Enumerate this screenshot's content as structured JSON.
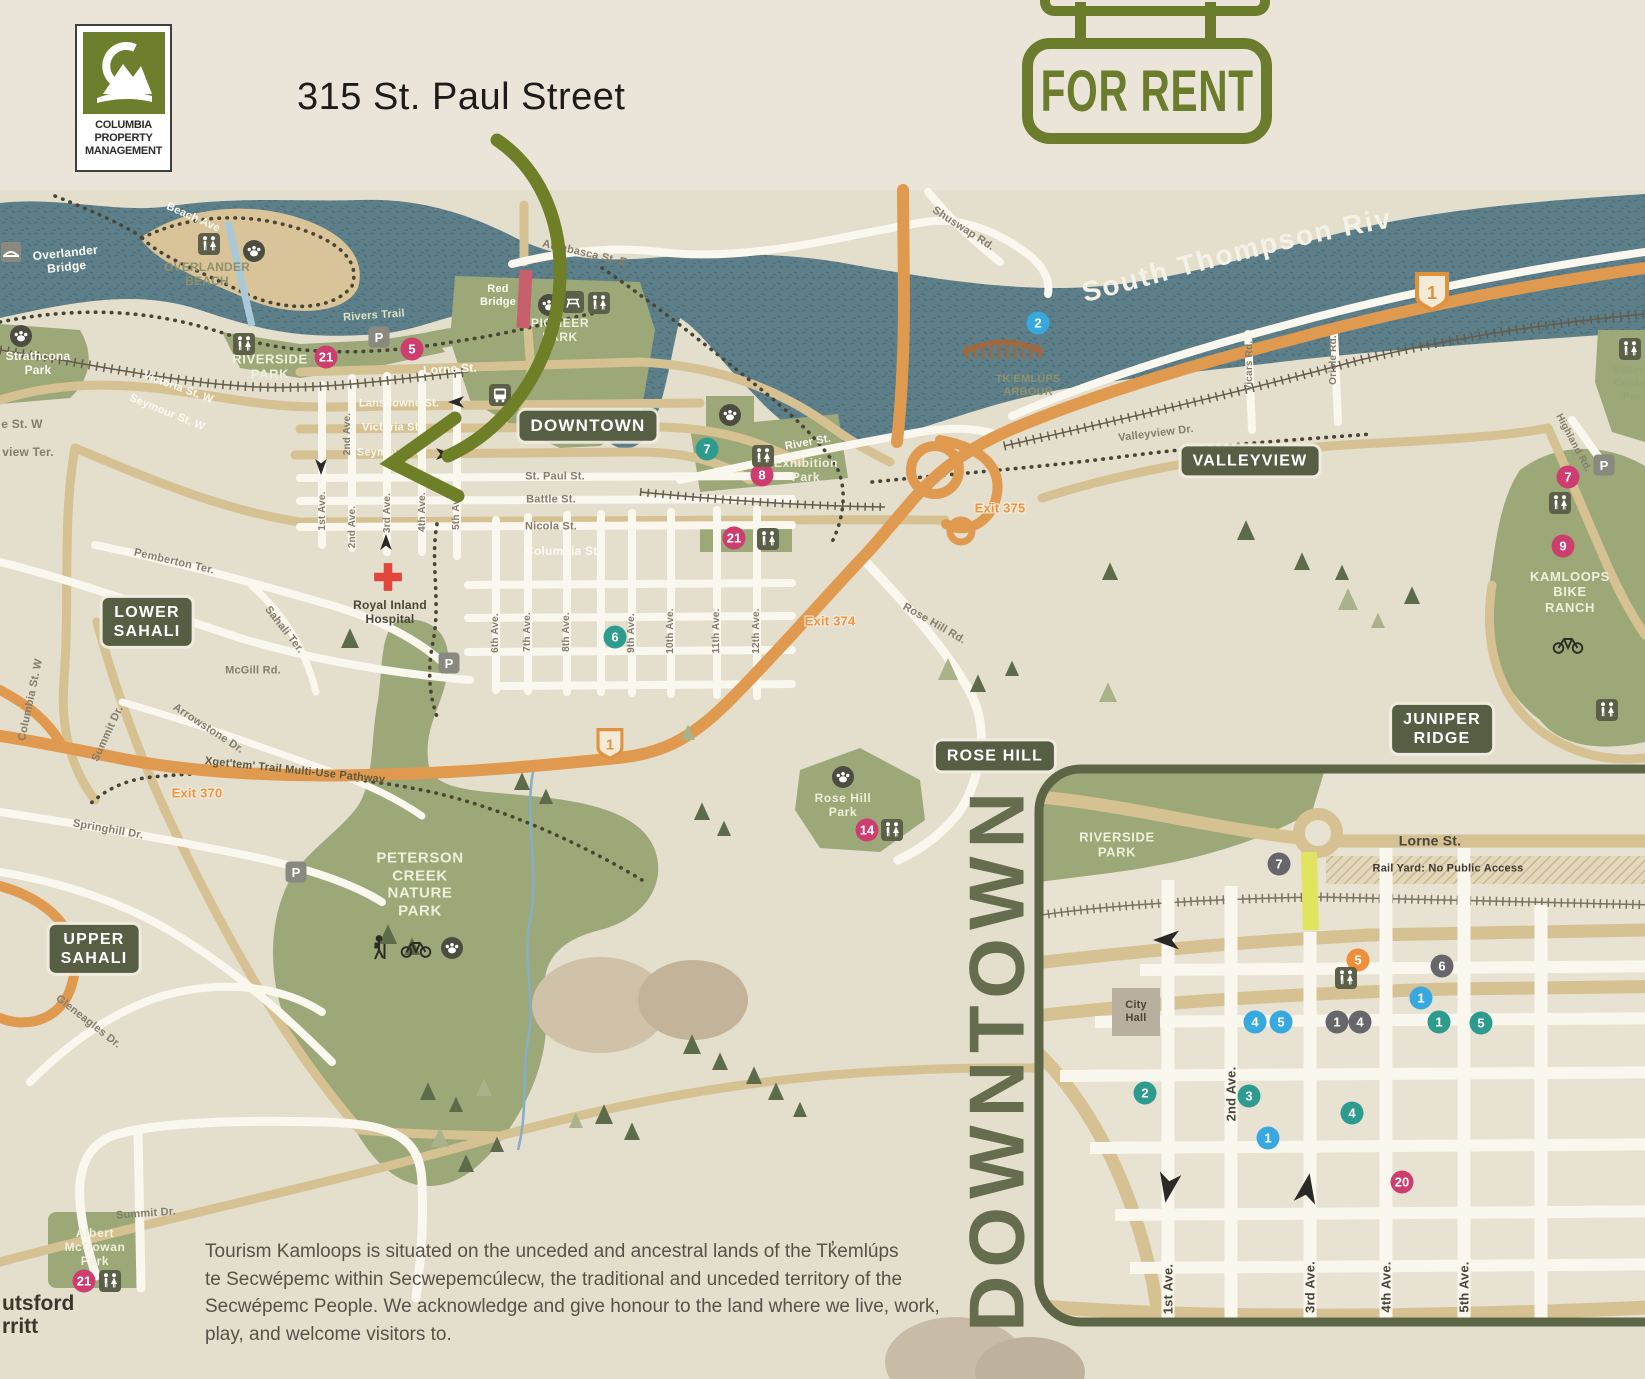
{
  "header": {
    "logo": {
      "monogram": "CM",
      "line1": "COLUMBIA",
      "line2": "PROPERTY",
      "line3": "MANAGEMENT"
    },
    "title": "315 St. Paul Street",
    "sign": "FOR RENT"
  },
  "colors": {
    "brand_green": "#6d7e2c",
    "badge_olive": "#565e44",
    "river_teal": "#5d7f8a",
    "highway_orange": "#e09a50",
    "pink": "#ce3d6f",
    "teal": "#2d9c8e",
    "blue": "#38a9e0",
    "orange": "#ef8f3a",
    "grey": "#67676b"
  },
  "map": {
    "river_label": "South Thompson River",
    "region_badges": [
      {
        "t": "DOWNTOWN",
        "x": 588,
        "y": 426,
        "s": 17
      },
      {
        "t": "VALLEYVIEW",
        "x": 1250,
        "y": 461,
        "s": 16
      },
      {
        "t": "LOWER\nSAHALI",
        "x": 147,
        "y": 622,
        "s": 16
      },
      {
        "t": "UPPER\nSAHALI",
        "x": 94,
        "y": 949,
        "s": 16
      },
      {
        "t": "ROSE HILL",
        "x": 995,
        "y": 756,
        "s": 16
      },
      {
        "t": "JUNIPER\nRIDGE",
        "x": 1442,
        "y": 729,
        "s": 16
      }
    ],
    "labels": [
      {
        "t": "Overlander\nBridge",
        "x": 66,
        "y": 260,
        "r": -6,
        "c": "white",
        "s": 12
      },
      {
        "t": "Beach Ave",
        "x": 193,
        "y": 218,
        "r": 24,
        "c": "white",
        "s": 11
      },
      {
        "t": "OVERLANDER\nBEACH",
        "x": 207,
        "y": 274,
        "c": "olive",
        "s": 12
      },
      {
        "t": "Strathcona\nPark",
        "x": 38,
        "y": 363,
        "c": "white",
        "s": 12
      },
      {
        "t": "RIVERSIDE\nPARK",
        "x": 270,
        "y": 367,
        "c": "parkname",
        "s": 13
      },
      {
        "t": "Rivers Trail",
        "x": 374,
        "y": 316,
        "r": -4,
        "c": "trail",
        "s": 11
      },
      {
        "t": "PIONEER\nPARK",
        "x": 560,
        "y": 330,
        "c": "parkname",
        "s": 12
      },
      {
        "t": "Red\nBridge",
        "x": 498,
        "y": 296,
        "c": "white",
        "s": 11
      },
      {
        "t": "Athabasca St. E.",
        "x": 586,
        "y": 254,
        "r": 13,
        "c": "grey",
        "s": 11
      },
      {
        "t": "Shuswap Rd.",
        "x": 963,
        "y": 229,
        "r": 33,
        "c": "grey",
        "s": 11
      },
      {
        "t": "Lorne St.",
        "x": 450,
        "y": 369,
        "r": -3,
        "c": "white",
        "s": 12
      },
      {
        "t": "Lansdowne St.",
        "x": 399,
        "y": 404,
        "c": "white",
        "s": 11
      },
      {
        "t": "Victoria St.",
        "x": 392,
        "y": 428,
        "c": "white",
        "s": 11
      },
      {
        "t": "Seymour St.",
        "x": 390,
        "y": 453,
        "c": "white",
        "s": 11
      },
      {
        "t": "Victoria St. W",
        "x": 178,
        "y": 388,
        "r": 20,
        "c": "white",
        "s": 11
      },
      {
        "t": "Seymour St. W",
        "x": 167,
        "y": 413,
        "r": 22,
        "c": "white",
        "s": 11
      },
      {
        "t": "St. Paul St.",
        "x": 555,
        "y": 477,
        "c": "grey",
        "s": 11
      },
      {
        "t": "Battle St.",
        "x": 551,
        "y": 500,
        "c": "grey",
        "s": 11
      },
      {
        "t": "Nicola St.",
        "x": 551,
        "y": 527,
        "c": "grey",
        "s": 11
      },
      {
        "t": "Columbia St.",
        "x": 563,
        "y": 551,
        "c": "white",
        "s": 12
      },
      {
        "t": "River St.",
        "x": 808,
        "y": 443,
        "r": -10,
        "c": "white",
        "s": 11
      },
      {
        "t": "e St. W",
        "x": 22,
        "y": 424,
        "c": "grey",
        "s": 12
      },
      {
        "t": "view Ter.",
        "x": 28,
        "y": 452,
        "c": "grey",
        "s": 12
      },
      {
        "t": "1st Ave.",
        "x": 323,
        "y": 511,
        "r": -90,
        "c": "grey",
        "s": 10
      },
      {
        "t": "2nd Ave.",
        "x": 348,
        "y": 434,
        "r": -90,
        "c": "grey",
        "s": 10
      },
      {
        "t": "2nd Ave.",
        "x": 353,
        "y": 527,
        "r": -90,
        "c": "grey",
        "s": 10
      },
      {
        "t": "3rd Ave.",
        "x": 388,
        "y": 513,
        "r": -90,
        "c": "grey",
        "s": 10
      },
      {
        "t": "4th Ave.",
        "x": 423,
        "y": 512,
        "r": -90,
        "c": "grey",
        "s": 10
      },
      {
        "t": "5th Ave.",
        "x": 457,
        "y": 510,
        "r": -90,
        "c": "grey",
        "s": 10
      },
      {
        "t": "6th Ave.",
        "x": 496,
        "y": 633,
        "r": -90,
        "c": "grey",
        "s": 10
      },
      {
        "t": "7th Ave.",
        "x": 528,
        "y": 632,
        "r": -90,
        "c": "grey",
        "s": 10
      },
      {
        "t": "8th Ave.",
        "x": 567,
        "y": 632,
        "r": -90,
        "c": "grey",
        "s": 10
      },
      {
        "t": "9th Ave.",
        "x": 632,
        "y": 633,
        "r": -90,
        "c": "grey",
        "s": 10
      },
      {
        "t": "10th Ave.",
        "x": 671,
        "y": 631,
        "r": -90,
        "c": "grey",
        "s": 10
      },
      {
        "t": "11th Ave.",
        "x": 717,
        "y": 631,
        "r": -90,
        "c": "grey",
        "s": 10
      },
      {
        "t": "12th Ave.",
        "x": 757,
        "y": 631,
        "r": -90,
        "c": "grey",
        "s": 10
      },
      {
        "t": "Vicars Rd.",
        "x": 1250,
        "y": 366,
        "r": -90,
        "c": "grey",
        "s": 10
      },
      {
        "t": "Oriole Rd.",
        "x": 1334,
        "y": 360,
        "r": -90,
        "c": "grey",
        "s": 10
      },
      {
        "t": "Valleyview Dr.",
        "x": 1156,
        "y": 434,
        "r": -7,
        "c": "grey",
        "s": 11
      },
      {
        "t": "Highland Rd.",
        "x": 1573,
        "y": 443,
        "r": 62,
        "c": "grey",
        "s": 10
      },
      {
        "t": "Rose Hill Rd.",
        "x": 934,
        "y": 624,
        "r": 30,
        "c": "grey",
        "s": 11
      },
      {
        "t": "Exhibition\nPark",
        "x": 806,
        "y": 470,
        "c": "parkname",
        "s": 12
      },
      {
        "t": "TK'EMLÚPS\nARBOUR",
        "x": 1028,
        "y": 386,
        "c": "olive",
        "s": 11
      },
      {
        "t": "Royal Inland\nHospital",
        "x": 390,
        "y": 612,
        "c": "poi",
        "s": 12
      },
      {
        "t": "Pemberton Ter.",
        "x": 174,
        "y": 562,
        "r": 13,
        "c": "grey",
        "s": 11
      },
      {
        "t": "Sahali Ter.",
        "x": 284,
        "y": 630,
        "r": 52,
        "c": "grey",
        "s": 11
      },
      {
        "t": "McGill Rd.",
        "x": 253,
        "y": 671,
        "c": "grey",
        "s": 11
      },
      {
        "t": "Arrowstone Dr.",
        "x": 208,
        "y": 729,
        "r": 33,
        "c": "grey",
        "s": 11
      },
      {
        "t": "Columbia St. W",
        "x": 31,
        "y": 700,
        "r": -78,
        "c": "grey",
        "s": 11
      },
      {
        "t": "Summit Dr.",
        "x": 108,
        "y": 734,
        "r": -65,
        "c": "grey",
        "s": 11
      },
      {
        "t": "Xget'tem' Trail Multi-Use Pathway",
        "x": 295,
        "y": 771,
        "r": 6,
        "c": "traildark",
        "s": 11
      },
      {
        "t": "Exit 375",
        "x": 1000,
        "y": 508,
        "c": "exit",
        "s": 13
      },
      {
        "t": "Exit 374",
        "x": 830,
        "y": 621,
        "c": "exit",
        "s": 13
      },
      {
        "t": "Exit 370",
        "x": 197,
        "y": 793,
        "c": "exit",
        "s": 13
      },
      {
        "t": "Springhill Dr.",
        "x": 108,
        "y": 830,
        "r": 10,
        "c": "grey",
        "s": 11
      },
      {
        "t": "Gleneagles Dr.",
        "x": 88,
        "y": 1022,
        "r": 38,
        "c": "grey",
        "s": 11
      },
      {
        "t": "PETERSON\nCREEK\nNATURE\nPARK",
        "x": 420,
        "y": 885,
        "c": "parkname",
        "s": 15
      },
      {
        "t": "Rose Hill\nPark",
        "x": 843,
        "y": 805,
        "c": "parkname",
        "s": 12
      },
      {
        "t": "KAMLOOPS\nBIKE\nRANCH",
        "x": 1570,
        "y": 592,
        "c": "parkname",
        "s": 13
      },
      {
        "t": "Valleyv\nCenter\nPar",
        "x": 1632,
        "y": 384,
        "c": "greenpoi",
        "s": 11
      },
      {
        "t": "Summit Dr.",
        "x": 146,
        "y": 1214,
        "r": -4,
        "c": "grey",
        "s": 11
      },
      {
        "t": "Albert\nMcGowan\nPark",
        "x": 95,
        "y": 1247,
        "c": "parkname",
        "s": 12
      }
    ],
    "markers": [
      {
        "n": "21",
        "c": "pink",
        "x": 326,
        "y": 357
      },
      {
        "n": "5",
        "c": "pink",
        "x": 412,
        "y": 349
      },
      {
        "n": "2",
        "c": "blue",
        "x": 1038,
        "y": 323
      },
      {
        "n": "7",
        "c": "teal",
        "x": 707,
        "y": 449
      },
      {
        "n": "8",
        "c": "pink",
        "x": 762,
        "y": 475
      },
      {
        "n": "21",
        "c": "pink",
        "x": 734,
        "y": 538
      },
      {
        "n": "6",
        "c": "teal",
        "x": 615,
        "y": 637
      },
      {
        "n": "7",
        "c": "pink",
        "x": 1568,
        "y": 477
      },
      {
        "n": "9",
        "c": "pink",
        "x": 1563,
        "y": 546
      },
      {
        "n": "14",
        "c": "pink",
        "x": 867,
        "y": 830
      },
      {
        "n": "21",
        "c": "pink",
        "x": 84,
        "y": 1281
      }
    ],
    "icons": [
      {
        "k": "bridge",
        "x": 11,
        "y": 252
      },
      {
        "k": "restroom",
        "x": 209,
        "y": 244
      },
      {
        "k": "paw",
        "x": 254,
        "y": 251
      },
      {
        "k": "paw",
        "x": 21,
        "y": 336
      },
      {
        "k": "parking",
        "x": 379,
        "y": 337
      },
      {
        "k": "restroom",
        "x": 244,
        "y": 344
      },
      {
        "k": "paw",
        "x": 549,
        "y": 305
      },
      {
        "k": "picnic",
        "x": 573,
        "y": 302
      },
      {
        "k": "restroom",
        "x": 599,
        "y": 303
      },
      {
        "k": "bus",
        "x": 500,
        "y": 395
      },
      {
        "k": "paw",
        "x": 730,
        "y": 415
      },
      {
        "k": "restroom",
        "x": 763,
        "y": 456
      },
      {
        "k": "restroom",
        "x": 768,
        "y": 539
      },
      {
        "k": "paw",
        "x": 843,
        "y": 777
      },
      {
        "k": "restroom",
        "x": 892,
        "y": 830
      },
      {
        "k": "parking",
        "x": 449,
        "y": 663
      },
      {
        "k": "parking",
        "x": 296,
        "y": 872
      },
      {
        "k": "hiker",
        "x": 380,
        "y": 948
      },
      {
        "k": "bike",
        "x": 416,
        "y": 948
      },
      {
        "k": "paw",
        "x": 452,
        "y": 948
      },
      {
        "k": "cross",
        "x": 388,
        "y": 577
      },
      {
        "k": "arbour",
        "x": 1003,
        "y": 347
      },
      {
        "k": "parking",
        "x": 1604,
        "y": 465
      },
      {
        "k": "restroom",
        "x": 1560,
        "y": 503
      },
      {
        "k": "restroom",
        "x": 1607,
        "y": 710
      },
      {
        "k": "restroom",
        "x": 1630,
        "y": 349
      },
      {
        "k": "bike",
        "x": 1568,
        "y": 644
      },
      {
        "k": "restroom",
        "x": 110,
        "y": 1281
      },
      {
        "k": "restroom",
        "x": 1346,
        "y": 978
      }
    ],
    "arrows": [
      {
        "x": 456,
        "y": 402,
        "d": 180,
        "s": 16
      },
      {
        "x": 444,
        "y": 454,
        "d": 0,
        "s": 16
      },
      {
        "x": 321,
        "y": 467,
        "d": 90,
        "s": 16
      },
      {
        "x": 386,
        "y": 542,
        "d": -90,
        "s": 16
      },
      {
        "x": 1166,
        "y": 940,
        "d": 180,
        "s": 26
      },
      {
        "x": 1168,
        "y": 1188,
        "d": 100,
        "s": 30
      },
      {
        "x": 1307,
        "y": 1188,
        "d": -80,
        "s": 30
      }
    ],
    "shields": [
      {
        "n": "1",
        "x": 1432,
        "y": 292,
        "sc": 1
      },
      {
        "n": "1",
        "x": 610,
        "y": 744,
        "sc": 0.8
      }
    ]
  },
  "inset": {
    "title": "DOWNTOWN",
    "labels": [
      {
        "t": "RIVERSIDE\nPARK",
        "x": 1117,
        "y": 845,
        "c": "parkname",
        "s": 13
      },
      {
        "t": "Lorne St.",
        "x": 1430,
        "y": 841,
        "c": "poi",
        "s": 14
      },
      {
        "t": "Rail Yard: No Public Access",
        "x": 1448,
        "y": 869,
        "c": "poibold",
        "s": 11
      },
      {
        "t": "City\nHall",
        "x": 1136,
        "y": 1012,
        "c": "poi",
        "s": 11
      },
      {
        "t": "1st Ave.",
        "x": 1168,
        "y": 1289,
        "r": -90,
        "c": "poi",
        "s": 13
      },
      {
        "t": "2nd Ave.",
        "x": 1231,
        "y": 1094,
        "r": -90,
        "c": "poi",
        "s": 13
      },
      {
        "t": "3rd Ave.",
        "x": 1310,
        "y": 1287,
        "r": -90,
        "c": "poi",
        "s": 13
      },
      {
        "t": "4th Ave.",
        "x": 1386,
        "y": 1287,
        "r": -90,
        "c": "poi",
        "s": 13
      },
      {
        "t": "5th Ave.",
        "x": 1464,
        "y": 1287,
        "r": -90,
        "c": "poi",
        "s": 13
      }
    ],
    "markers": [
      {
        "n": "7",
        "c": "grey",
        "x": 1279,
        "y": 864
      },
      {
        "n": "5",
        "c": "orange",
        "x": 1358,
        "y": 960
      },
      {
        "n": "6",
        "c": "grey",
        "x": 1442,
        "y": 966
      },
      {
        "n": "1",
        "c": "blue",
        "x": 1421,
        "y": 998
      },
      {
        "n": "4",
        "c": "blue",
        "x": 1255,
        "y": 1022
      },
      {
        "n": "5",
        "c": "blue",
        "x": 1281,
        "y": 1022
      },
      {
        "n": "1",
        "c": "grey",
        "x": 1337,
        "y": 1022
      },
      {
        "n": "4",
        "c": "grey",
        "x": 1360,
        "y": 1022
      },
      {
        "n": "1",
        "c": "teal",
        "x": 1439,
        "y": 1022
      },
      {
        "n": "5",
        "c": "teal",
        "x": 1481,
        "y": 1023
      },
      {
        "n": "2",
        "c": "teal",
        "x": 1145,
        "y": 1093
      },
      {
        "n": "3",
        "c": "teal",
        "x": 1249,
        "y": 1096
      },
      {
        "n": "4",
        "c": "teal",
        "x": 1352,
        "y": 1113
      },
      {
        "n": "1",
        "c": "blue",
        "x": 1268,
        "y": 1138
      },
      {
        "n": "20",
        "c": "pink",
        "x": 1402,
        "y": 1182
      }
    ]
  },
  "footer": {
    "acknowledgment": "Tourism Kamloops is situated on the unceded and ancestral lands of the Tk̓emlúps\nte Secwépemc within Secwepemcúlecw, the traditional and unceded territory of the\nSecwépemc People. We acknowledge and give honour to the land where we live, work,\nplay, and welcome visitors to.",
    "cutoff_line1": "utsford",
    "cutoff_line2": "rritt"
  }
}
